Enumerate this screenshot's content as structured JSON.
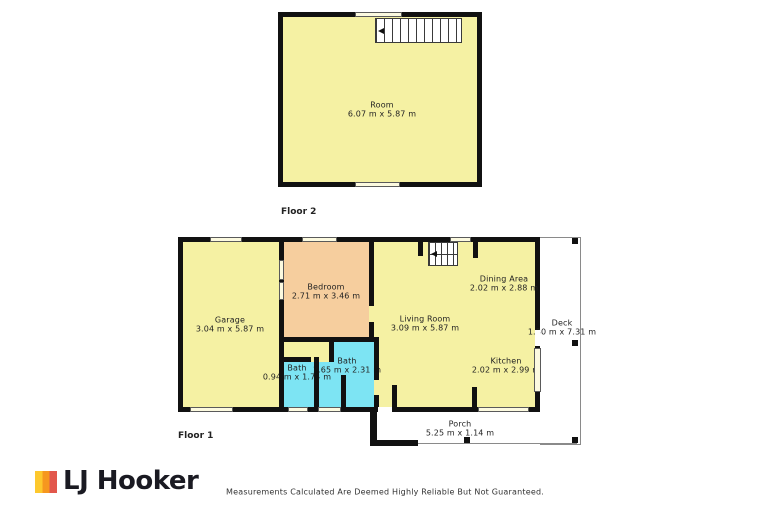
{
  "floor2": {
    "tag": "Floor 2",
    "room": {
      "name": "Room",
      "dims": "6.07 m x 5.87 m"
    }
  },
  "floor1": {
    "tag": "Floor 1",
    "rooms": {
      "garage": {
        "name": "Garage",
        "dims": "3.04 m x 5.87 m"
      },
      "bedroom": {
        "name": "Bedroom",
        "dims": "2.71 m x 3.46 m"
      },
      "living": {
        "name": "Living Room",
        "dims": "3.09 m x 5.87 m"
      },
      "dining": {
        "name": "Dining Area",
        "dims": "2.02 m x 2.88 m"
      },
      "kitchen": {
        "name": "Kitchen",
        "dims": "2.02 m x 2.99 m"
      },
      "bath_small": {
        "name": "Bath",
        "dims": "0.94 m x 1.74 m"
      },
      "bath_large": {
        "name": "Bath",
        "dims": "1.65 m x 2.31 m"
      },
      "deck": {
        "name": "Deck",
        "dims": "1.30 m x 7.31 m"
      },
      "porch": {
        "name": "Porch",
        "dims": "5.25 m x 1.14 m"
      }
    }
  },
  "brand": {
    "name": "LJ Hooker"
  },
  "footer": {
    "disclaimer": "Measurements Calculated Are Deemed Highly Reliable But Not Guaranteed."
  },
  "colors": {
    "wall": "#111111",
    "room_yellow": "#F5F1A3",
    "bedroom_orange": "#F6CE9E",
    "bath_cyan": "#7DE4F3",
    "logo_yellow": "#FDC82D",
    "logo_orange": "#F6971F",
    "logo_red": "#E2574C",
    "logo_text": "#1A1A22"
  }
}
